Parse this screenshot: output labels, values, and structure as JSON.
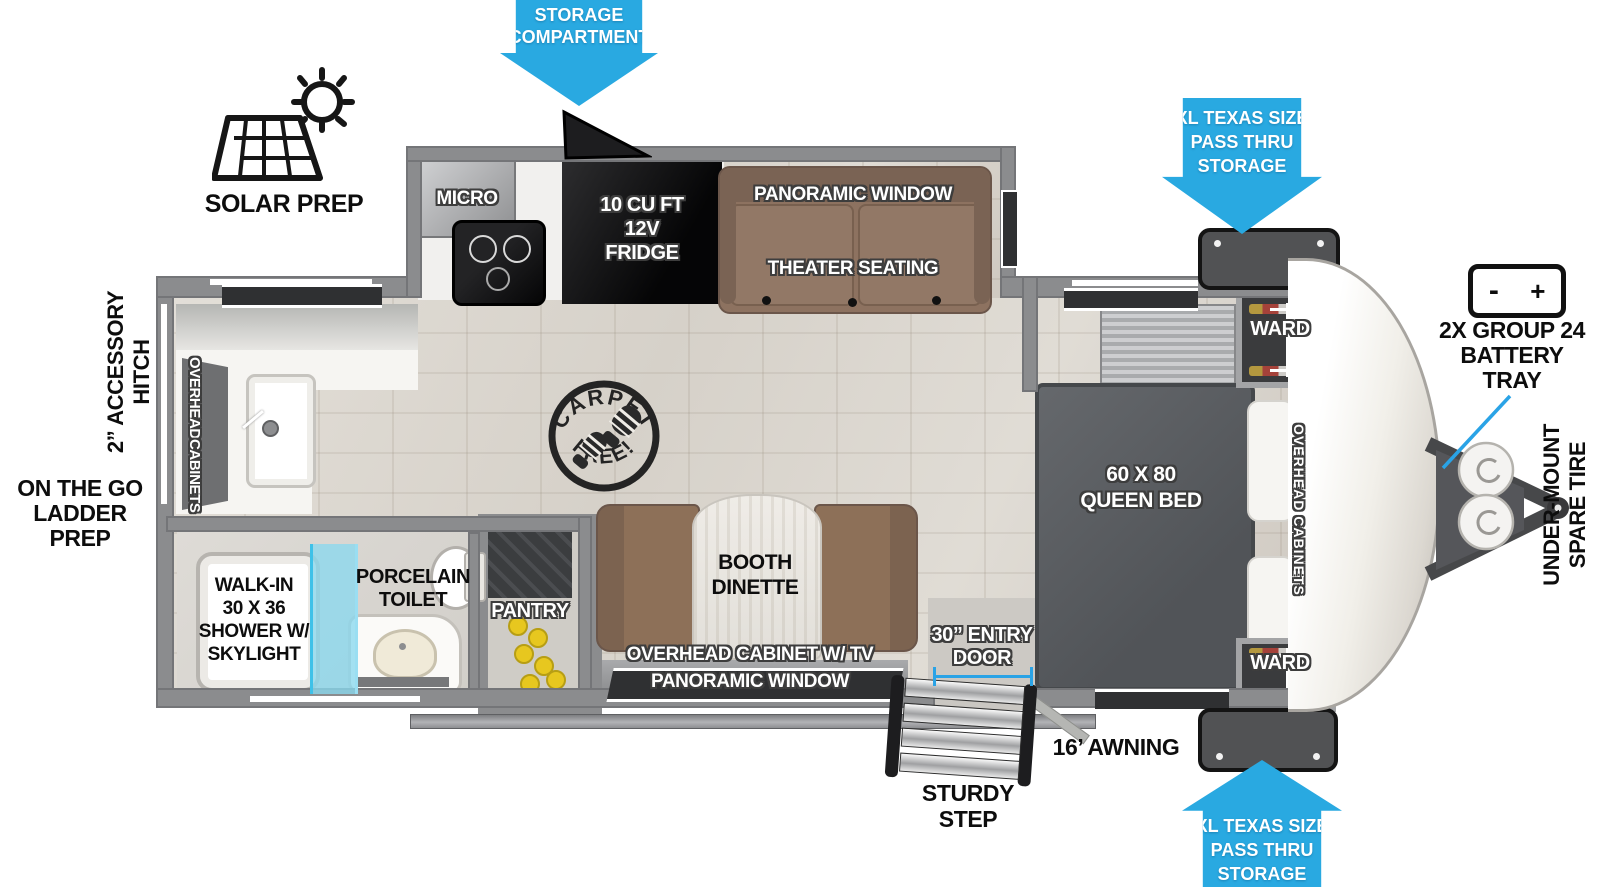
{
  "title": "travel-trailer-floorplan",
  "colors": {
    "arrow_blue": "#29a9e1",
    "dimension_blue": "#2aa3e6",
    "wall_gray": "#8b8c8e",
    "bed_gray": "#5a5d60",
    "sofa_brown": "#8d7260",
    "can_yellow": "#e7c71f"
  },
  "exterior": {
    "solar_prep_label": "SOLAR PREP",
    "storage_arrow_lines": [
      "STORAGE",
      "COMPARTMENT"
    ],
    "passthru_lines": [
      "XL TEXAS SIZE",
      "PASS THRU",
      "STORAGE"
    ],
    "battery_lines": [
      "2X GROUP 24",
      "BATTERY",
      "TRAY"
    ],
    "battery_minus": "-",
    "battery_plus": "+",
    "spare_tire_lines": [
      "UNDER-MOUNT",
      "SPARE TIRE"
    ],
    "hitch_lines": [
      "2” ACCESSORY",
      "HITCH"
    ],
    "ladder_lines": [
      "ON THE GO",
      "LADDER PREP"
    ],
    "awning_label": "16’ AWNING",
    "step_lines": [
      "STURDY",
      "STEP"
    ],
    "entry_door_lines": [
      "30” ENTRY",
      "DOOR"
    ]
  },
  "interior": {
    "micro_label": "MICRO",
    "fridge_lines": [
      "10 CU FT",
      "12V",
      "FRIDGE"
    ],
    "panoramic_window_top": "PANORAMIC WINDOW",
    "theater_seating": "THEATER SEATING",
    "ward_label": "WARD",
    "overhead_cabinets_bed": "OVERHEAD CABINETS",
    "overhead_cabinets_kitchen_lines": [
      "OVERHEAD",
      "CABINETS"
    ],
    "queen_bed_lines": [
      "60 X 80",
      "QUEEN BED"
    ],
    "stamp_top": "CARPET",
    "stamp_bottom": "FREE!",
    "dinette_lines": [
      "BOOTH",
      "DINETTE"
    ],
    "pantry_label": "PANTRY",
    "overhead_cabinet_tv": "OVERHEAD CABINET W/ TV",
    "panoramic_window_bottom": "PANORAMIC WINDOW",
    "shower_lines": [
      "WALK-IN",
      "30 X 36",
      "SHOWER W/",
      "SKYLIGHT"
    ],
    "toilet_lines": [
      "PORCELAIN",
      "TOILET"
    ]
  }
}
